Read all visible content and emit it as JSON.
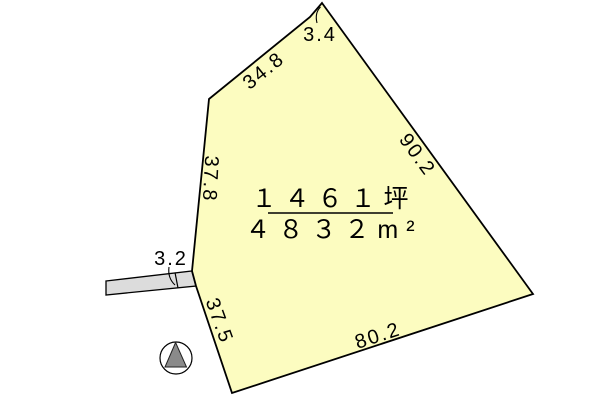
{
  "parcel": {
    "area_tsubo": "１４６１坪",
    "area_sqm": "４８３２m²",
    "edges": {
      "top_left": "34.8",
      "apex": "3.4",
      "right": "90.2",
      "left": "37.8",
      "bottom_left": "37.5",
      "bottom": "80.2"
    },
    "road": {
      "width_label": "3.2"
    },
    "colors": {
      "parcel_fill": "#fcfcc0",
      "road_fill": "#dcdcdc",
      "outline": "#000000",
      "north_triangle": "#8a8a8a"
    }
  },
  "compass": {
    "icon": "north-arrow-icon"
  }
}
